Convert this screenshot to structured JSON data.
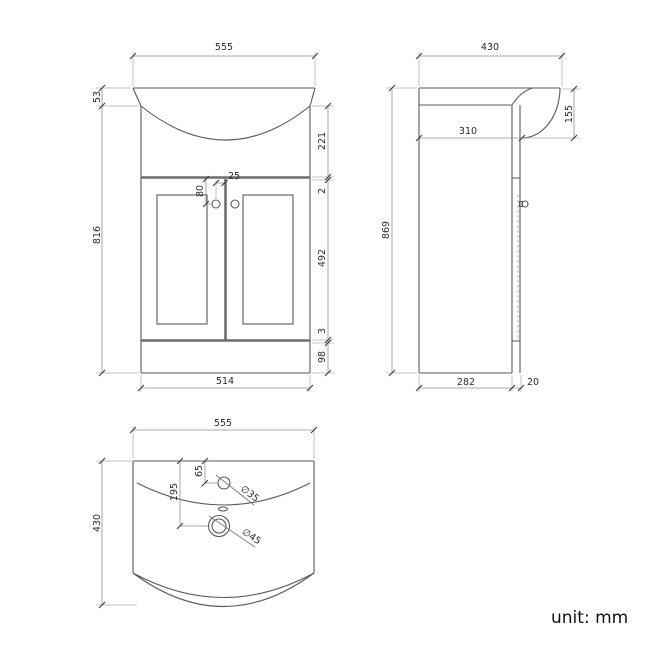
{
  "front_view": {
    "dims": {
      "width_top": "555",
      "rim_height": "53",
      "height_below_rim": "816",
      "basin_depth": "221",
      "top_gap": "2",
      "door_height": "492",
      "bottom_gap": "3",
      "plinth_height": "98",
      "width_bottom": "514",
      "handle_drop": "80",
      "handle_inset": "25"
    }
  },
  "side_view": {
    "dims": {
      "depth_top": "430",
      "basin_front_height": "155",
      "flat_depth": "310",
      "total_height": "869",
      "cabinet_depth": "282",
      "door_thickness": "20"
    }
  },
  "top_view": {
    "dims": {
      "width": "555",
      "depth": "430",
      "tap_offset": "65",
      "drain_offset": "195",
      "tap_diameter": "∅35",
      "drain_diameter": "∅45"
    }
  },
  "note": {
    "unit_label": "unit: mm"
  },
  "colors": {
    "line": "#5a5a5a",
    "dimension": "#909090",
    "text": "#2b2b2b",
    "background": "#ffffff"
  }
}
